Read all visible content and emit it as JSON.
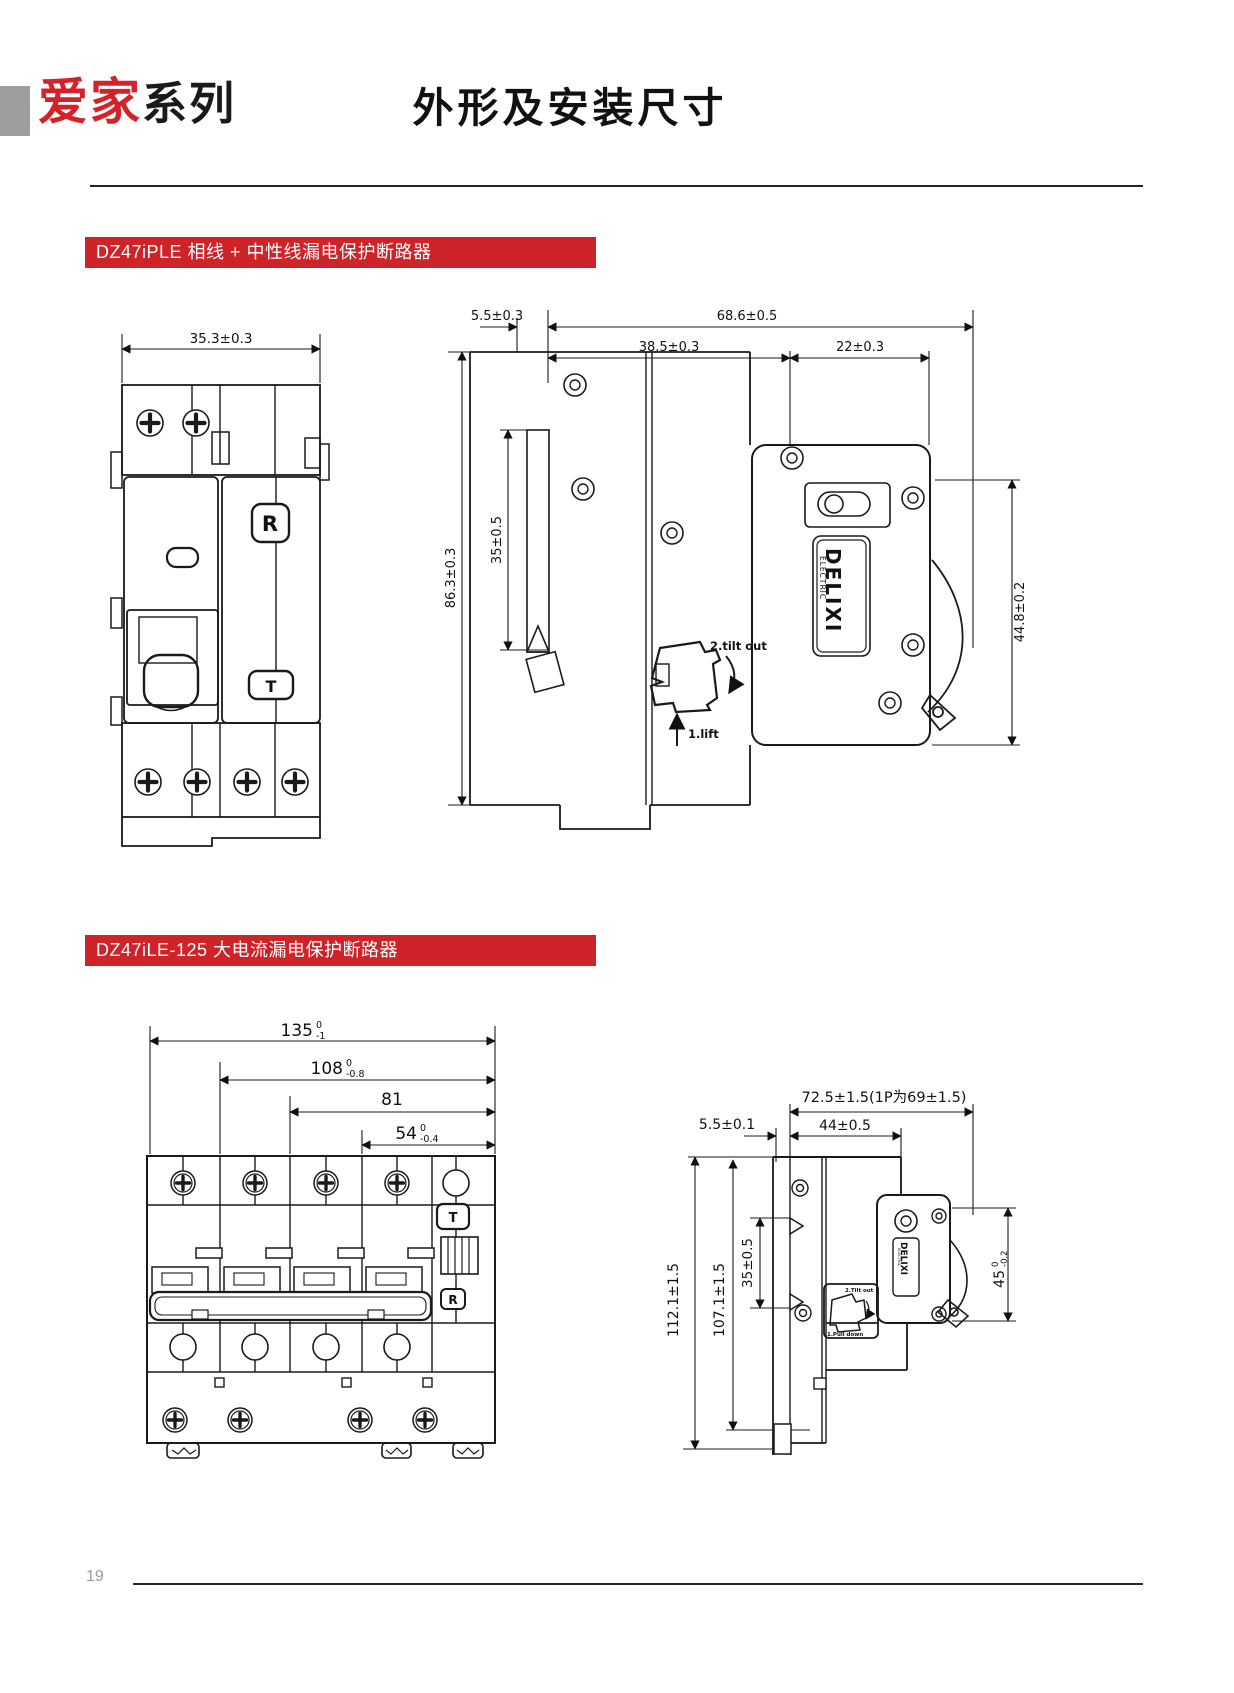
{
  "header": {
    "logo_primary": "爱家",
    "logo_secondary": "系列",
    "title": "外形及安装尺寸"
  },
  "footer": {
    "page_number": "19"
  },
  "colors": {
    "accent": "#ce2328",
    "logo_red": "#d42229"
  },
  "s1": {
    "banner": "DZ47iPLE 相线 + 中性线漏电保护断路器",
    "fv_width": "35.3±0.3",
    "fv_r": "R",
    "fv_t": "T",
    "sv_gap": "5.5±0.3",
    "sv_total": "68.6±0.5",
    "sv_front": "38.5±0.3",
    "sv_out": "22±0.3",
    "sv_height": "86.3±0.3",
    "sv_rail": "35±0.5",
    "sv_body": "44.8±0.2",
    "sv_step2": "2.tilt out",
    "sv_step1": "1.lift",
    "brand1": "DELIXI",
    "brand2": "ELECTRIC"
  },
  "s2": {
    "banner": "DZ47iLE-125 大电流漏电保护断路器",
    "fv_w1": "135",
    "fv_w1_hi": "0",
    "fv_w1_lo": "-1",
    "fv_w2": "108",
    "fv_w2_hi": "0",
    "fv_w2_lo": "-0.8",
    "fv_w3": "81",
    "fv_w4": "54",
    "fv_w4_hi": "0",
    "fv_w4_lo": "-0.4",
    "fv_t": "T",
    "fv_r": "R",
    "sv_total": "72.5±1.5(1P为69±1.5)",
    "sv_gap": "5.5±0.1",
    "sv_front": "44±0.5",
    "sv_h1": "112.1±1.5",
    "sv_h2": "107.1±1.5",
    "sv_rail": "35±0.5",
    "sv_body": "45",
    "sv_body_hi": "0",
    "sv_body_lo": "-0.2",
    "sv_step2": "2.Tilt out",
    "sv_step1": "1.Pull down",
    "brand1": "DELIXI",
    "brand2": "ELECTRIC"
  }
}
